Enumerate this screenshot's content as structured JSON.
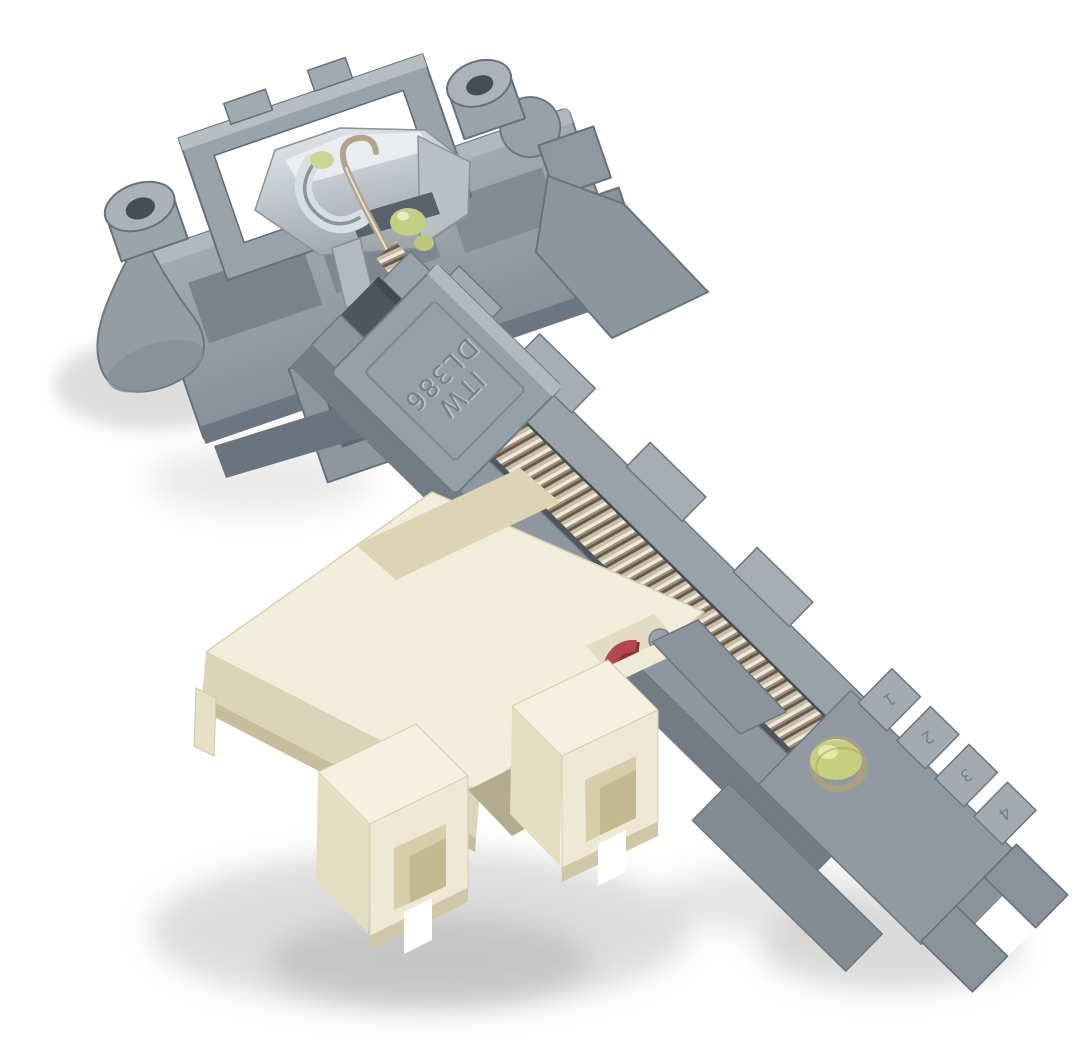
{
  "image": {
    "type": "product-photograph",
    "subject": "dishwasher door lock latch assembly",
    "background": "#ffffff"
  },
  "markings": {
    "brand": "ITW",
    "model": "DL386"
  },
  "rack_numbers": [
    "1",
    "2",
    "3",
    "4"
  ],
  "parts": {
    "mounting_plate": "mounting-plate",
    "screw_boss_left": "screw-boss-left",
    "screw_boss_top": "screw-boss-top",
    "latch_claw": "latch-claw",
    "tension_spring": "tension-spring",
    "spring_channel": "spring-channel",
    "adjustment_rack": "adjustment-rack",
    "end_cap": "end-cap",
    "switch_housing": "switch-housing",
    "connector_socket_left": "connector-socket-left",
    "connector_socket_right": "connector-socket-right",
    "switch_actuator": "switch-actuator",
    "grease_dab": "grease-dab"
  },
  "colors": {
    "gray_plastic": "#8e969e",
    "gray_light": "#adb4bb",
    "gray_dark": "#6a737d",
    "cream_plastic": "#f2eedb",
    "cream_shadow": "#dcd4b8",
    "spring_metal": "#b0a48d",
    "zinc_metal": "#c9ced3",
    "red_actuator": "#b5464e",
    "green_grease": "#c6cf7d"
  }
}
